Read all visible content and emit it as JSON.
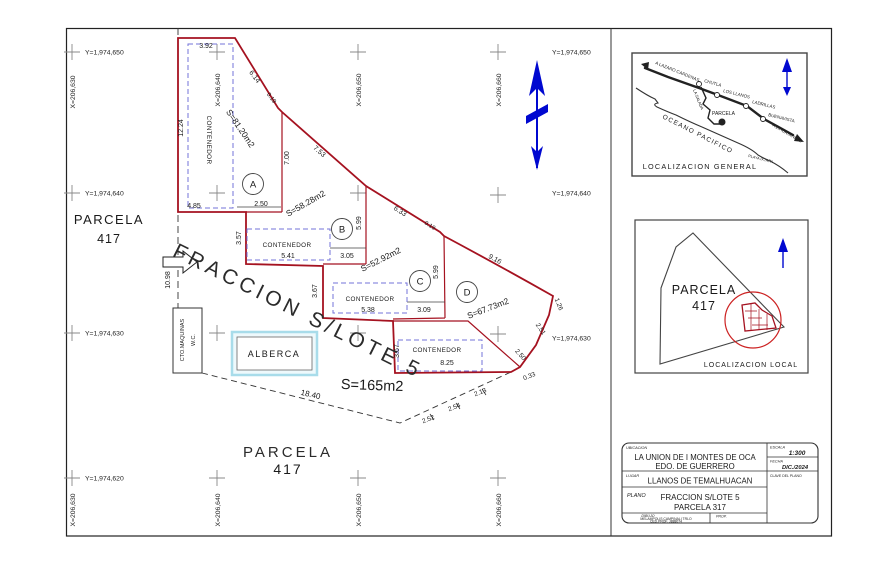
{
  "plan": {
    "labels": {
      "contenedor": "CONTENEDOR",
      "alberca": "ALBERCA",
      "cto": "CTO.MAQUINAS",
      "wc": "W.C.",
      "fraccion": "FRACCION S/LOTE 5",
      "parcela": "PARCELA",
      "parcela_num": "417"
    },
    "ids": {
      "a": "A",
      "b": "B",
      "c": "C",
      "d": "D"
    },
    "areas": {
      "a": "S=81.20m2",
      "b": "S=58.28m2",
      "c": "S=52.92m2",
      "d": "S=67.73m2",
      "total": "S=165m2"
    },
    "dims": {
      "a_top": "3.92",
      "a_left": "12.24",
      "a_diag": "6.14",
      "a_jog": "0.19",
      "ab_diag": "7.53",
      "a_right": "7.00",
      "a_bot1": "4.85",
      "a_bot2": "2.50",
      "b_left": "3.57",
      "b_width": "5.41",
      "b_step": "3.05",
      "b_right": "5.99",
      "bc_diag": "6.33",
      "bc_jog": "0.19",
      "c_left": "3.67",
      "c_width": "5.38",
      "c_step": "3.09",
      "c_right": "5.99",
      "cd_diag": "9.16",
      "edge1": "1.26",
      "edge2": "2.51",
      "edge3": "2.50",
      "edge4": "0.33",
      "strip_left": "3.67",
      "strip_width": "8.25",
      "chain1": "2.13",
      "chain2": "2.54",
      "chain3": "2.52",
      "base": "18.40",
      "access": "10.98"
    }
  },
  "coords": {
    "y650": "Y=1,974,650",
    "y640": "Y=1,974,640",
    "y630": "Y=1,974,630",
    "y620": "Y=1,974,620",
    "x630": "X=206,630",
    "x640": "X=206,640",
    "x650": "X=206,650",
    "x660": "X=206,660"
  },
  "general_map": {
    "title": "LOCALIZACION GENERAL",
    "road_nw": "A LAZARO CARDENAS",
    "road_se": "A ZIHUATANEJO",
    "town1": "CHUTLA",
    "town2": "LOS LLANOS",
    "town3": "LADRILLAS",
    "town4": "BUENAVISTA",
    "branch": "LA SALADA",
    "ocean": "OCEANO PACIFICO",
    "beach": "PLAYA IXTAPA",
    "parcela": "PARCELA"
  },
  "local_map": {
    "title": "LOCALIZACION LOCAL"
  },
  "titleblock": {
    "ubicacion_label": "UBICACION",
    "ubicacion1": "LA UNION DE I MONTES DE OCA",
    "ubicacion2": "EDO. DE GUERRERO",
    "lugar_label": "LUGAR",
    "lugar": "LLANOS DE TEMALHUACAN",
    "plano_label": "PLANO",
    "plano1": "FRACCION S/LOTE 5",
    "plano2": "PARCELA 317",
    "escala_label": "ESCALA",
    "escala": "1:300",
    "fecha_label": "FECHA",
    "fecha": "DIC./2024",
    "clave_label": "CLAVE DEL PLANO",
    "dibujo_label": "DIBUJO",
    "dibujo1": "MELAMPOLIS CAMPINALI TRLO",
    "dibujo2": "CED.PROF. J888074",
    "prop_label": "PROP."
  },
  "colors": {
    "boundary_red": "#a51220",
    "guide_blue": "#7373d9",
    "north_blue": "#0008d0",
    "pool_cyan": "#a8dcea"
  }
}
